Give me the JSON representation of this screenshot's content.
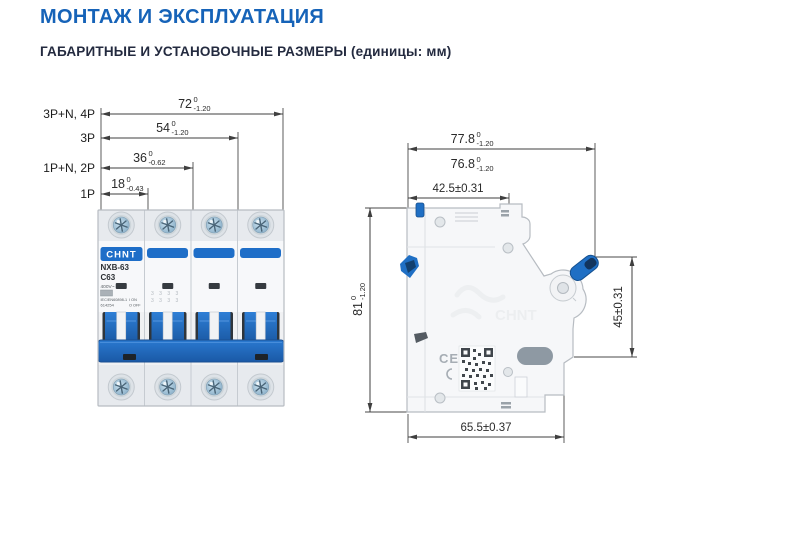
{
  "page": {
    "title": "МОНТАЖ И ЭКСПЛУАТАЦИЯ",
    "subtitle": "ГАБАРИТНЫЕ И УСТАНОВОЧНЫЕ РАЗМЕРЫ (единицы: мм)"
  },
  "colors": {
    "title_blue": "#1663b8",
    "subtitle_dark": "#232a3f",
    "breaker_blue": "#2172c8",
    "dimension_line": "#3f3f3f"
  },
  "front_view": {
    "dims": [
      {
        "pole_label": "3P+N, 4P",
        "value": "72",
        "tol_upper": "0",
        "tol_lower": "-1.20"
      },
      {
        "pole_label": "3P",
        "value": "54",
        "tol_upper": "0",
        "tol_lower": "-1.20"
      },
      {
        "pole_label": "1P+N, 2P",
        "value": "36",
        "tol_upper": "0",
        "tol_lower": "-0.62"
      },
      {
        "pole_label": "1P",
        "value": "18",
        "tol_upper": "0",
        "tol_lower": "-0.43"
      }
    ],
    "device": {
      "brand": "CHNT",
      "model": "NXB-63",
      "rating": "C63",
      "voltage": "400V~",
      "standard": "IEC/EN60898-1",
      "code": "614254",
      "on_mark": "I ON",
      "off_mark": "O OFF",
      "mold_marks": "3 3 3 3"
    }
  },
  "side_view": {
    "dims": {
      "overall_width": {
        "value": "77.8",
        "tol_upper": "0",
        "tol_lower": "-1.20"
      },
      "body_width": {
        "value": "76.8",
        "tol_upper": "0",
        "tol_lower": "-1.20"
      },
      "rail_to_front": "42.5±0.31",
      "height": {
        "value": "81",
        "tol_upper": "0",
        "tol_lower": "-1.20"
      },
      "front_section_height": "45±0.31",
      "bottom_width": "65.5±0.37"
    },
    "markings": {
      "ce": "CE",
      "emboss": "CHNT"
    }
  }
}
